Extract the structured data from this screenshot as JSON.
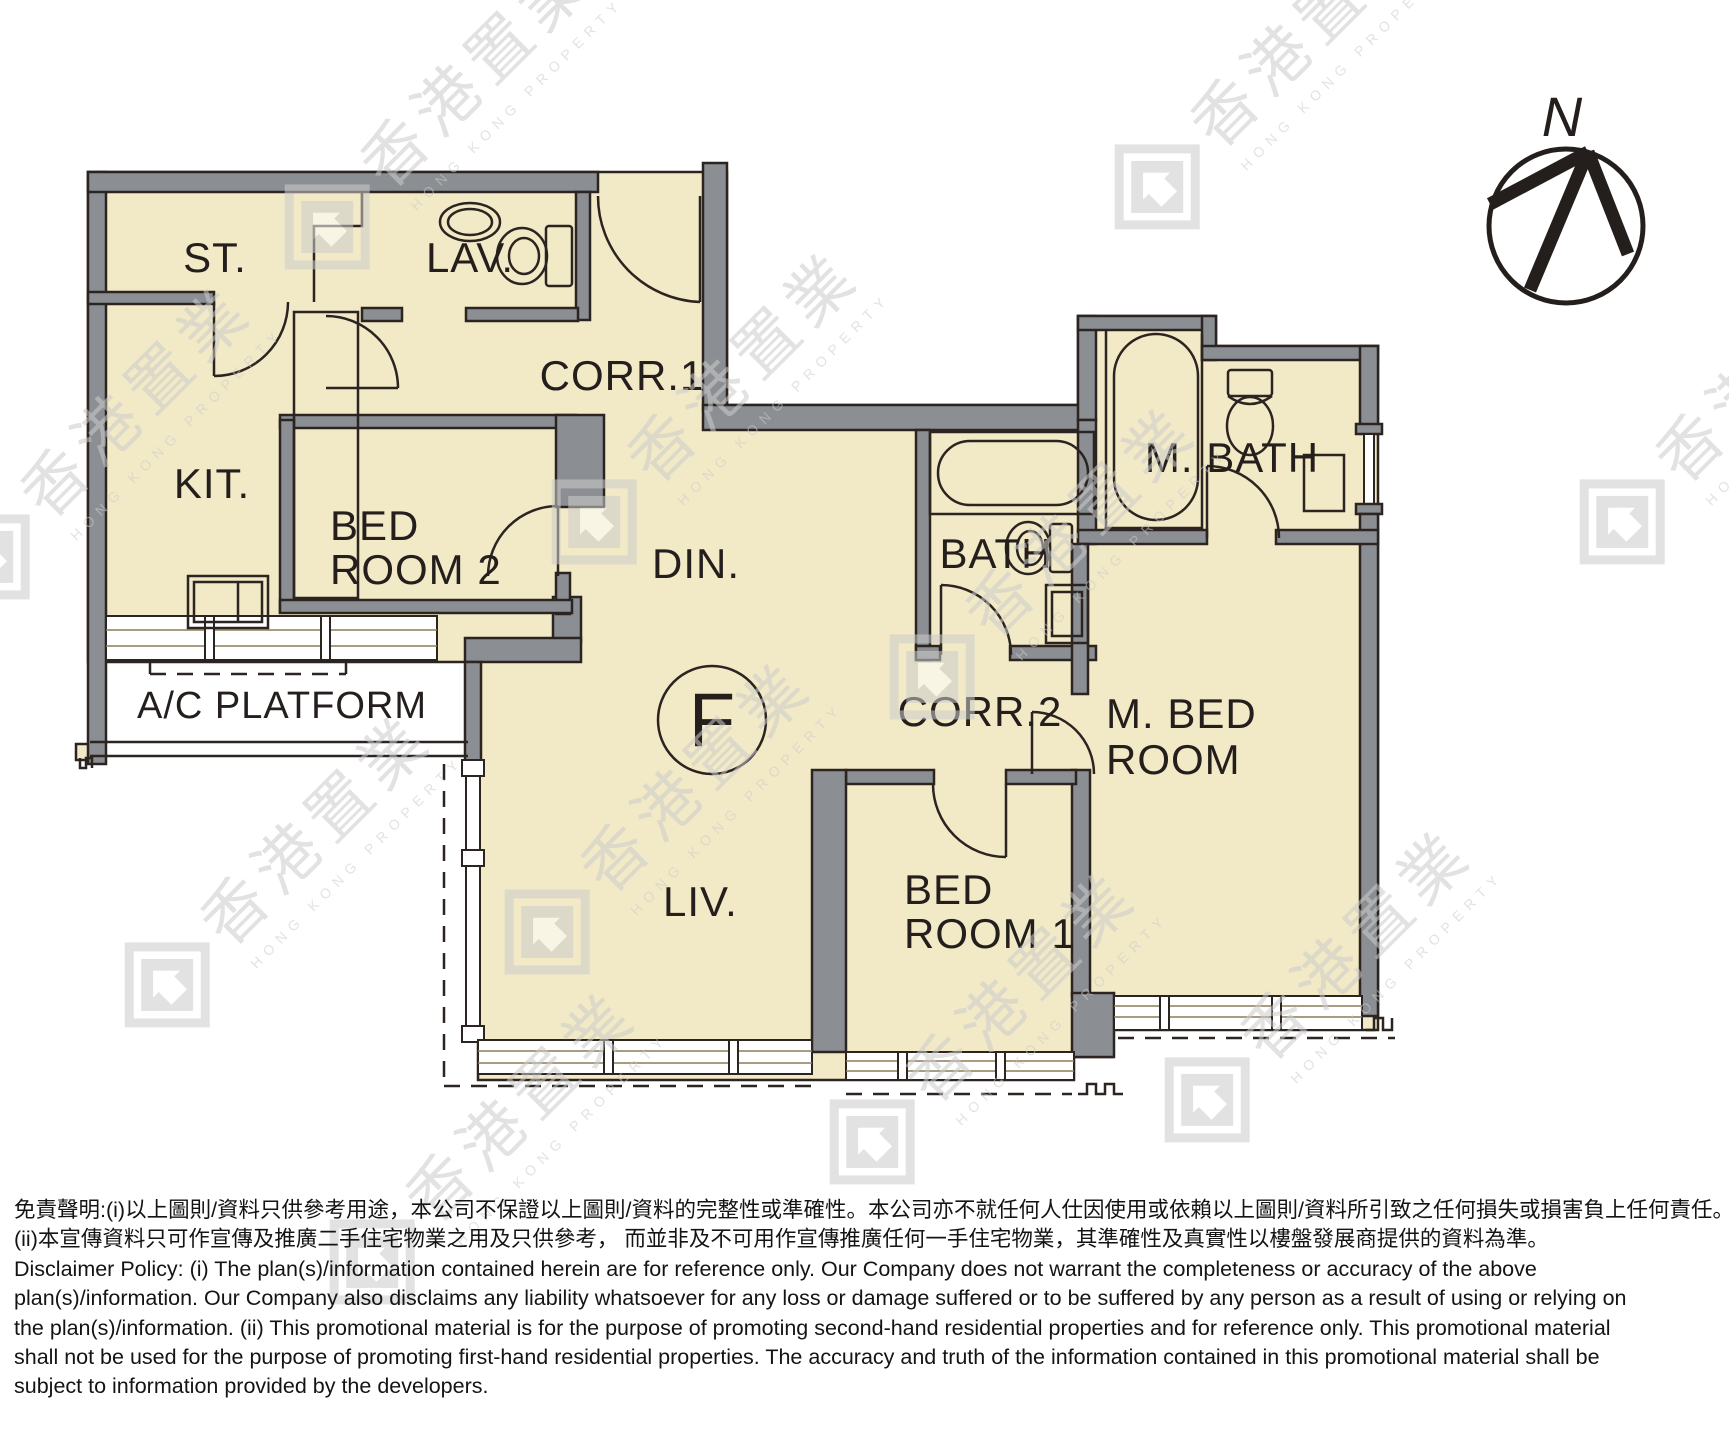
{
  "floor_plan": {
    "unit_label": "F",
    "compass": {
      "north_label": "N"
    },
    "rooms": {
      "st": "ST.",
      "lav": "LAV.",
      "kit": "KIT.",
      "bedroom2_line1": "BED",
      "bedroom2_line2": "ROOM 2",
      "corr1": "CORR.1",
      "din": "DIN.",
      "bath": "BATH",
      "m_bath": "M. BATH",
      "corr2": "CORR.2",
      "m_bed_line1": "M. BED",
      "m_bed_line2": "ROOM",
      "liv": "LIV.",
      "bedroom1_line1": "BED",
      "bedroom1_line2": "ROOM 1",
      "ac_platform": "A/C PLATFORM"
    },
    "colors": {
      "floor": "#f2e9c7",
      "wall_gray": "#8b8e92",
      "line": "#2b2420",
      "watermark": "#cccccc"
    }
  },
  "watermark": {
    "cjk": "香港置業",
    "latin": "HONG KONG PROPERTY"
  },
  "disclaimer": {
    "lines": [
      "免責聲明:(i)以上圖則/資料只供參考用途，本公司不保證以上圖則/資料的完整性或準確性。本公司亦不就任何人仕因使用或依賴以上圖則/資料所引致之任何損失或損害負上任何責任。",
      "(ii)本宣傳資料只可作宣傳及推廣二手住宅物業之用及只供參考， 而並非及不可用作宣傳推廣任何一手住宅物業，其準確性及真實性以樓盤發展商提供的資料為準。",
      "Disclaimer Policy: (i) The plan(s)/information contained herein are for reference only. Our Company does not warrant the completeness or accuracy of the above",
      "plan(s)/information. Our Company also disclaims any liability whatsoever for any loss or damage suffered or to be suffered by any person as a result of using or relying on",
      "the plan(s)/information. (ii) This promotional material is for the purpose of promoting second-hand residential properties and for reference only. This promotional material",
      "shall not be used for the purpose of promoting first-hand residential properties. The accuracy and truth of the information contained in this promotional material shall be",
      "subject to information provided by the developers."
    ]
  }
}
